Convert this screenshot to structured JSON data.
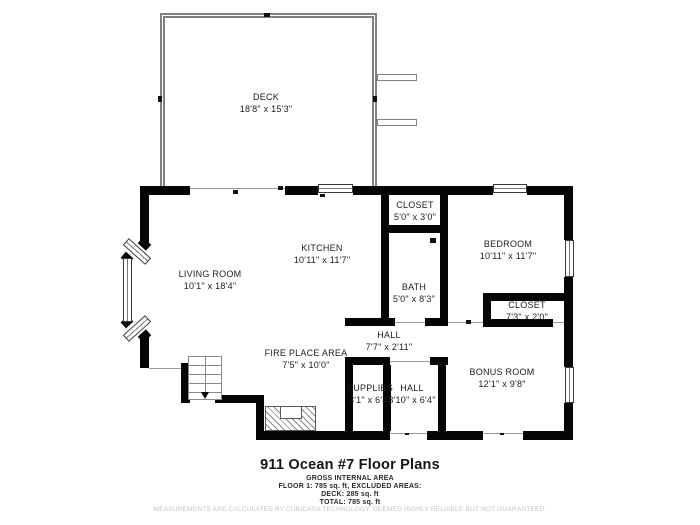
{
  "title": "911 Ocean #7 Floor Plans",
  "area_lines": [
    "GROSS INTERNAL AREA",
    "FLOOR 1: 785 sq. ft, EXCLUDED AREAS:",
    "DECK: 285 sq. ft",
    "TOTAL: 785 sq. ft"
  ],
  "disclaimer": "MEASUREMENTS ARE CALCULATED BY CUBICASA TECHNOLOGY. DEEMED HIGHLY RELIABLE BUT NOT GUARANTEED.",
  "rooms": [
    {
      "name": "DECK",
      "dims": "18'8\" x 15'3\""
    },
    {
      "name": "LIVING ROOM",
      "dims": "10'1\" x 18'4\""
    },
    {
      "name": "KITCHEN",
      "dims": "10'11\" x 11'7\""
    },
    {
      "name": "CLOSET",
      "dims": "5'0\" x 3'0\""
    },
    {
      "name": "BEDROOM",
      "dims": "10'11\" x 11'7\""
    },
    {
      "name": "BATH",
      "dims": "5'0\" x 8'3\""
    },
    {
      "name": "CLOSET",
      "dims": "7'3\" x 2'0\""
    },
    {
      "name": "HALL",
      "dims": "7'7\" x 2'11\""
    },
    {
      "name": "FIRE PLACE AREA",
      "dims": "7'5\" x 10'0\""
    },
    {
      "name": "SUPPLIES",
      "dims": "3'1\" x 6'4\""
    },
    {
      "name": "HALL",
      "dims": "3'10\" x 6'4\""
    },
    {
      "name": "BONUS ROOM",
      "dims": "12'1\" x 9'8\""
    }
  ],
  "colors": {
    "wall": "#050505",
    "deck_rail": "#818181",
    "opening_line": "#9a9a9a",
    "disclaimer_text": "#c7c2c2"
  }
}
